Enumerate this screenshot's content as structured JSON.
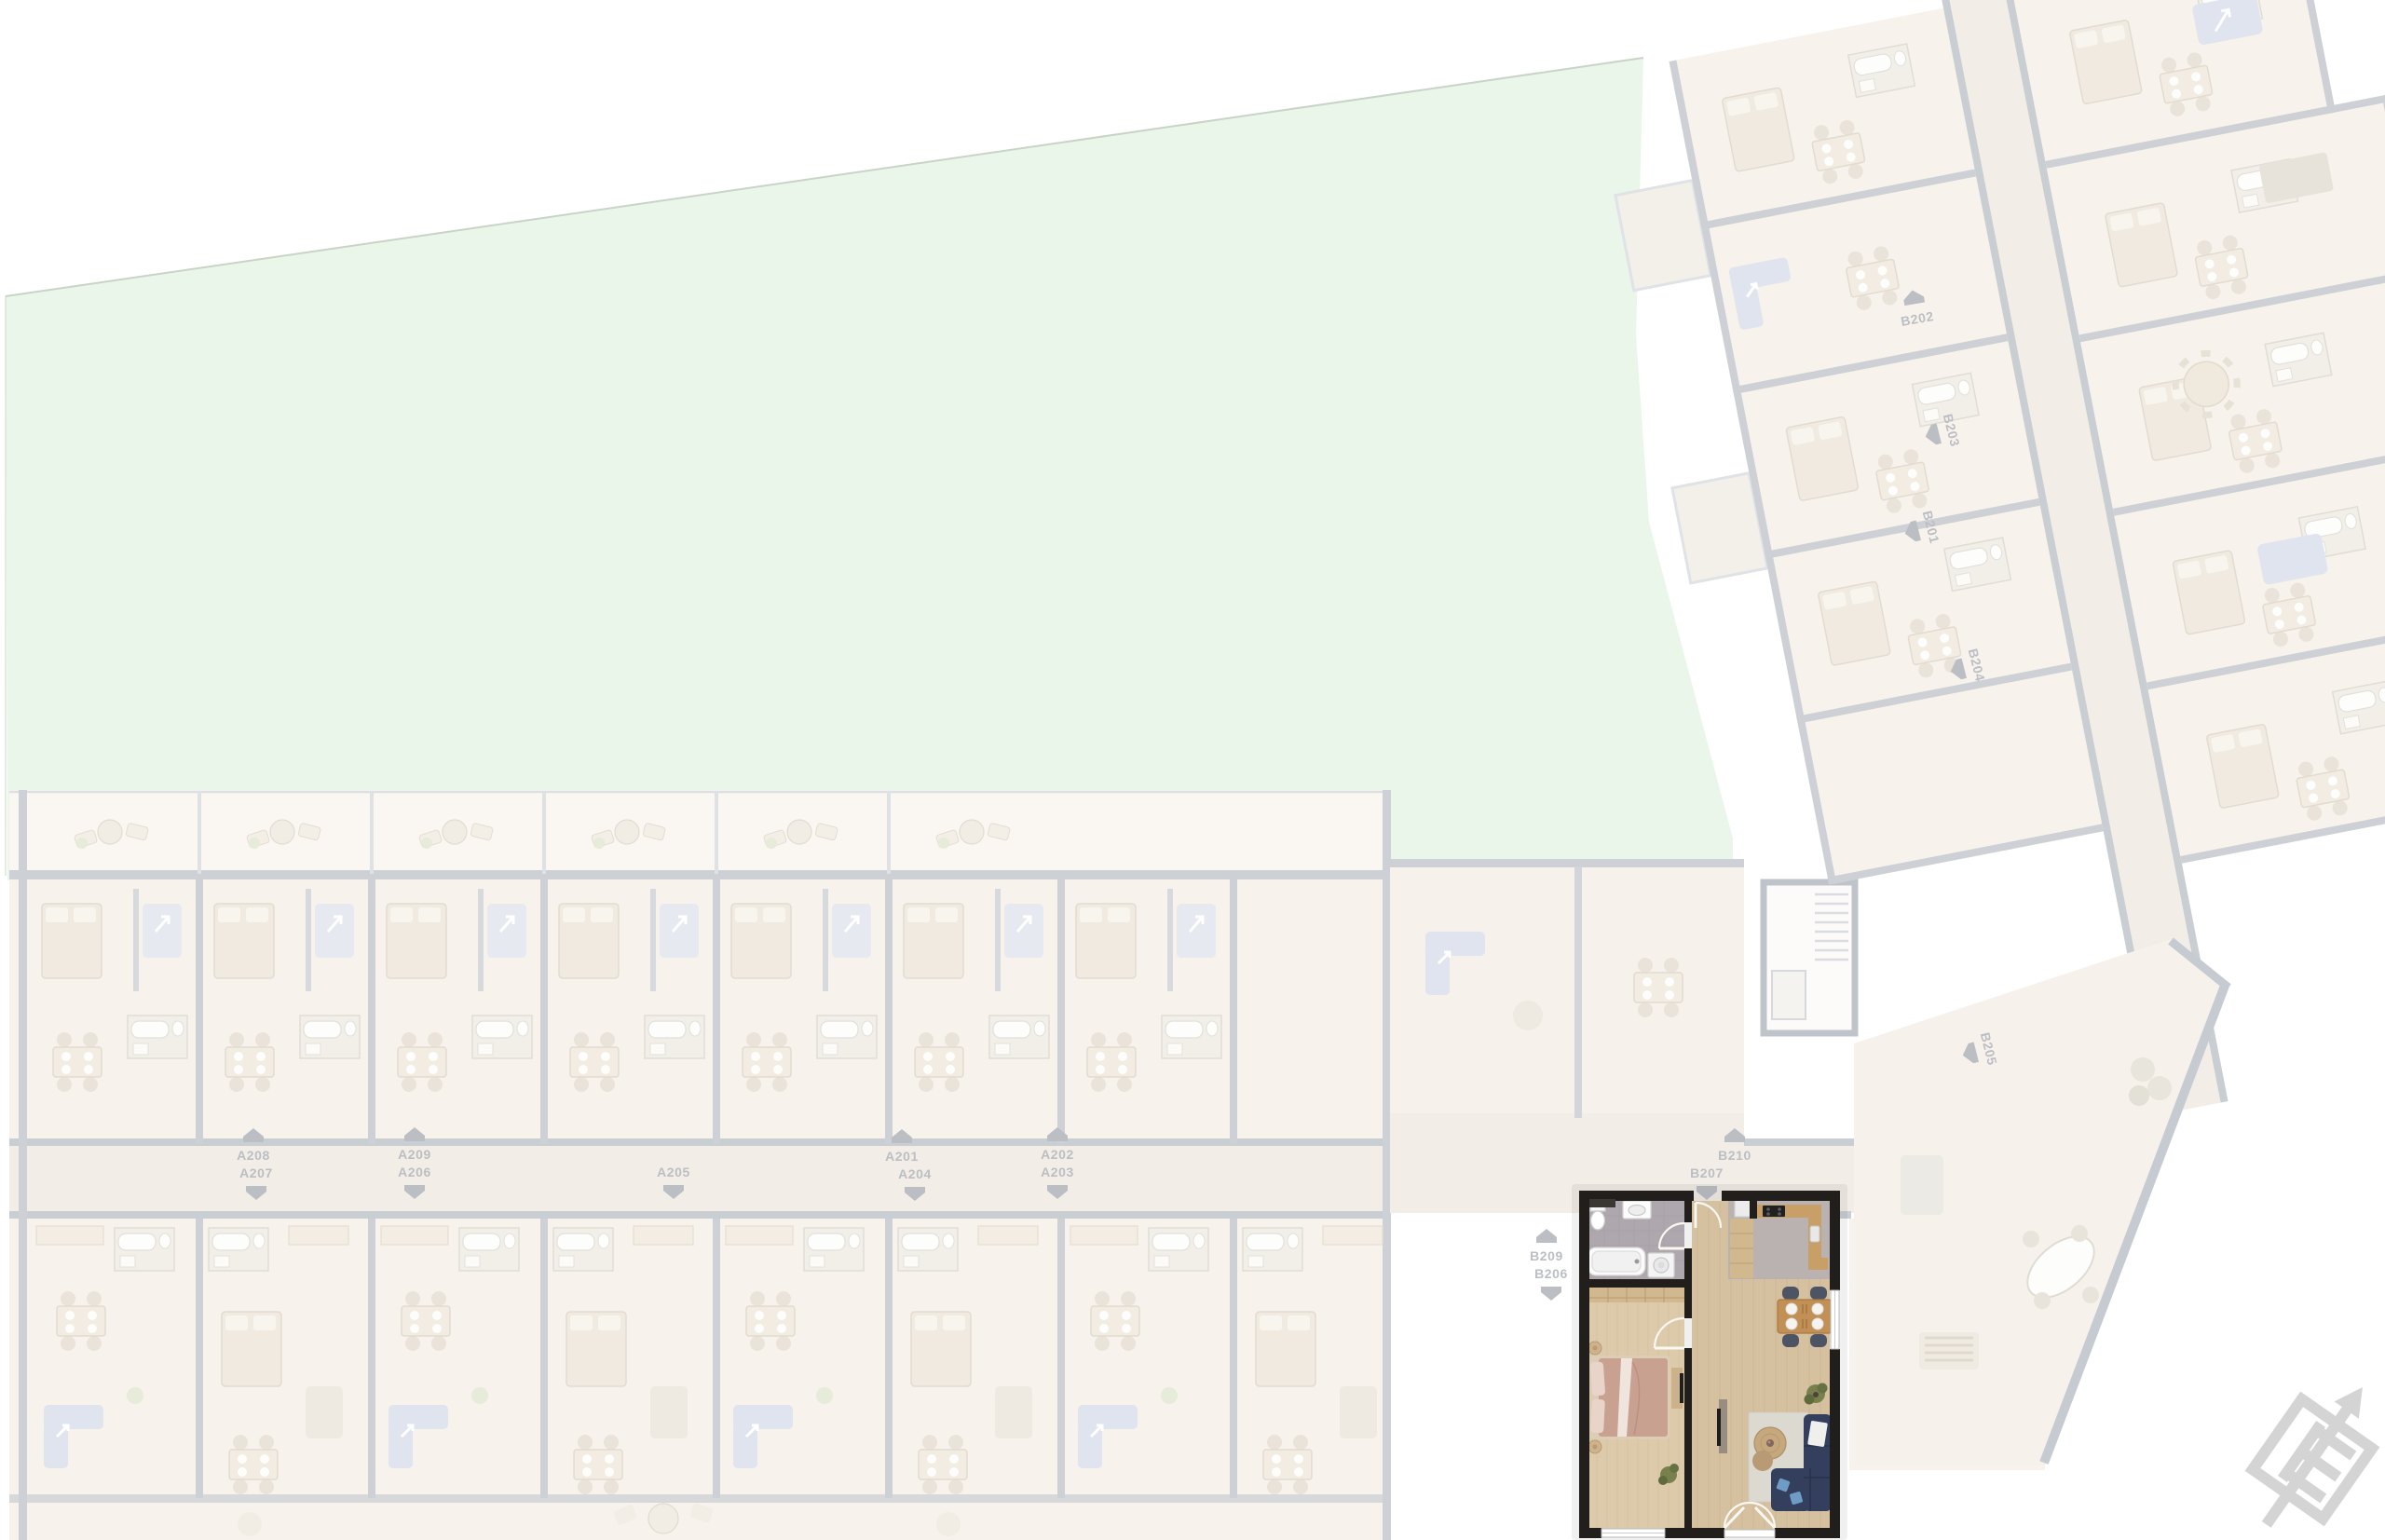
{
  "site": {
    "background_color": "#ffffff",
    "courtyard_color": "#eaf6ea",
    "courtyard_edge_color": "#c7d4c6"
  },
  "faded_plan": {
    "floor_color": "#f7f2ec",
    "corridor_color": "#f2eee7",
    "balcony_color": "#faf6f1",
    "wall_color": "#cdd1d6",
    "wall_strong_color": "#bfc4ca",
    "fixture_color": "#fcfbf9",
    "fixture_edge_color": "#e3e0da",
    "furniture_color": "#ece6de",
    "furniture_edge_color": "#e0d9cf",
    "wood_hint_color": "#f1e9dc",
    "navy_hint_color": "#dde3ee",
    "plant_hint_color": "#e4ead8",
    "label_color": "#bbbec3",
    "unit_labels": [
      {
        "text": "A208"
      },
      {
        "text": "A207"
      },
      {
        "text": "A209"
      },
      {
        "text": "A206"
      },
      {
        "text": "A205"
      },
      {
        "text": "A201"
      },
      {
        "text": "A204"
      },
      {
        "text": "A202"
      },
      {
        "text": "A203"
      },
      {
        "text": "B209"
      },
      {
        "text": "B206"
      },
      {
        "text": "B210"
      },
      {
        "text": "B207"
      },
      {
        "text": "B202"
      },
      {
        "text": "B203"
      },
      {
        "text": "B201"
      },
      {
        "text": "B204"
      },
      {
        "text": "B205"
      }
    ]
  },
  "highlighted_unit": {
    "label": "B207",
    "colors": {
      "wall": "#211e1b",
      "wood_floor": "#d5c09f",
      "bedroom_floor": "#dccaab",
      "bath_floor": "#aea7ad",
      "kitchen_floor": "#b9b2b1",
      "counter": "#c89f67",
      "cabinet": "#d2b88e",
      "dining_table": "#c29055",
      "chair": "#4d5464",
      "bed_frame": "#dbcdb6",
      "bed_duvet": "#c8a190",
      "bed_pillow": "#e8d4c8",
      "sofa": "#333f5d",
      "sofa_seam": "#27324c",
      "pillow_blue": "#6f9cc4",
      "rug": "#dcd9d1",
      "coffee_table": "#c5a87e",
      "pouf": "#b89a74",
      "plant": "#78814e",
      "fixture": "#fbfbfb",
      "fixture_edge": "#d2d2d2",
      "door": "#fbf8f2"
    }
  },
  "compass_logo": {
    "color": "#d4d4d4"
  }
}
